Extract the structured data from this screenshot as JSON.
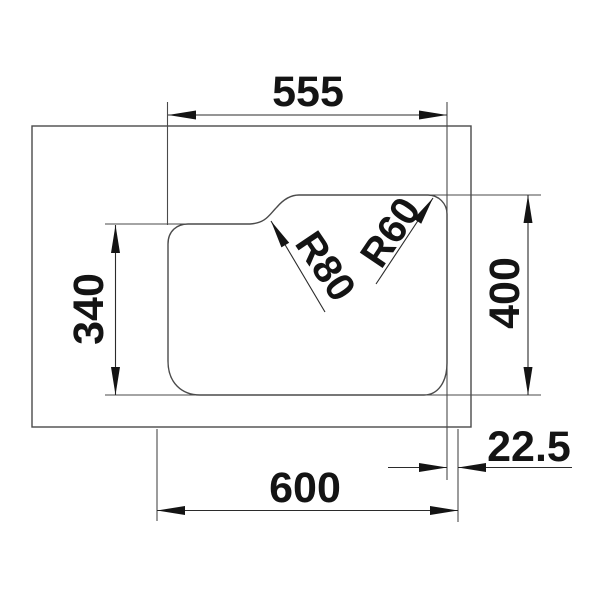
{
  "drawing": {
    "kind": "technical-dimension-diagram",
    "subject": "sink bowl top view with installation dimensions",
    "units": "mm",
    "background_color": "#ffffff",
    "line_color": "#4a4a4a",
    "ink_color": "#141414"
  },
  "dims": {
    "bowl_width": {
      "label": "555",
      "value": 555
    },
    "bowl_left_depth": {
      "label": "340",
      "value": 340
    },
    "bowl_right_depth": {
      "label": "400",
      "value": 400
    },
    "overall_width": {
      "label": "600",
      "value": 600
    },
    "edge_offset": {
      "label": "22.5",
      "value": 22.5
    },
    "notch_radius": {
      "label": "R80",
      "value": 80
    },
    "corner_radius": {
      "label": "R60",
      "value": 60
    }
  }
}
